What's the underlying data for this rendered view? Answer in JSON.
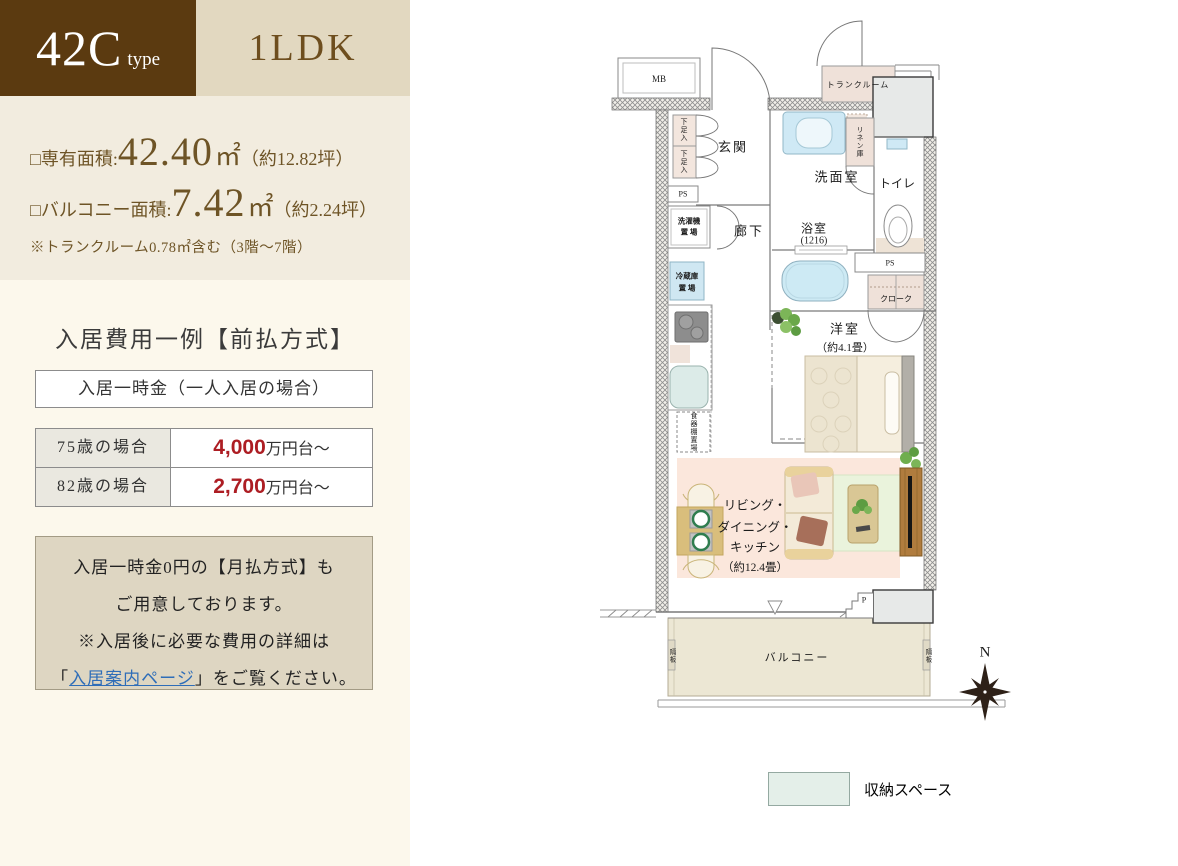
{
  "header": {
    "type_code": "42C",
    "type_suffix": "type",
    "layout": "1LDK"
  },
  "specs": {
    "area_label": "□専有面積:",
    "area_value": "42.40",
    "area_unit": "㎡",
    "area_tsubo": "（約12.82坪）",
    "balcony_label": "□バルコニー面積:",
    "balcony_value": "7.42",
    "balcony_unit": "㎡",
    "balcony_tsubo": "（約2.24坪）",
    "note": "※トランクルーム0.78㎡含む（3階〜7階）"
  },
  "pricing": {
    "title": "入居費用一例【前払方式】",
    "box_title": "入居一時金（一人入居の場合）",
    "rows": [
      {
        "label": "75歳の場合",
        "value": "4,000",
        "suffix": "万円台〜"
      },
      {
        "label": "82歳の場合",
        "value": "2,700",
        "suffix": "万円台〜"
      }
    ],
    "note_line1": "入居一時金0円の【月払方式】も",
    "note_line2": "ご用意しております。",
    "note_line3": "※入居後に必要な費用の詳細は",
    "note_open": "「",
    "note_link": "入居案内ページ",
    "note_close": "」をご覧ください。"
  },
  "plan": {
    "mb": "MB",
    "trunk": "トランクルーム",
    "genkan": "玄関",
    "shoe": "下足入",
    "ps": "PS",
    "washer_l1": "洗濯機",
    "washer_l2": "置 場",
    "hallway": "廊下",
    "fridge_l1": "冷蔵庫",
    "fridge_l2": "置 場",
    "dish": "食器棚置場",
    "washroom": "洗面室",
    "linen": "リネン庫",
    "bath_l1": "浴室",
    "bath_l2": "(1216)",
    "toilet": "トイレ",
    "cloak": "クローク",
    "west_l1": "洋室",
    "west_l2": "（約4.1畳）",
    "ldk_l1": "リビング・",
    "ldk_l2": "ダイニング・",
    "ldk_l3": "キッチン",
    "ldk_l4": "（約12.4畳）",
    "balcony": "バルコニー",
    "separator": "隔板",
    "pipe": "P"
  },
  "compass": {
    "north": "N"
  },
  "legend": {
    "label": "収納スペース",
    "swatch_color": "#e4efe9"
  },
  "colors": {
    "accent_dark_brown": "#5b3a10",
    "accent_beige": "#e2d8c0",
    "spec_bg": "#f2ecdf",
    "cream_bg": "#fcf8ec",
    "price_red": "#ad1d23",
    "link_blue": "#2e6db8",
    "storage_pink": "#efe1d9",
    "ldk_pink": "#fbe7dc",
    "legend_green": "#e4efe9",
    "water_blue": "#cdeaf4",
    "balcony_beige": "#ece7d4"
  }
}
